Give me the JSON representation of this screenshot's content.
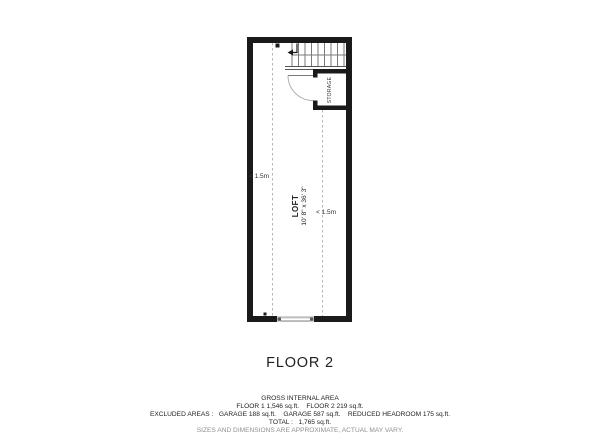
{
  "plan": {
    "loft_label": "LOFT",
    "loft_dimensions": "10' 8\" x 36' 3\"",
    "storage_label": "STORAGE",
    "clearance_left": "< 1.5m",
    "clearance_right": "< 1.5m"
  },
  "floor_title": "FLOOR 2",
  "footer": {
    "gross_internal_area": "GROSS INTERNAL AREA",
    "floor_areas": "FLOOR 1 1,546 sq.ft.    FLOOR 2 219 sq.ft.",
    "excluded_areas": "EXCLUDED AREAS :   GARAGE 188 sq.ft.    GARAGE 587 sq.ft.    REDUCED HEADROOM 175 sq.ft.",
    "total": "TOTAL :   1,765 sq.ft.",
    "disclaimer": "SIZES AND DIMENSIONS ARE APPROXIMATE, ACTUAL MAY VARY."
  },
  "colors": {
    "wall": "#1a1a1a",
    "thin_line": "#8a8a8a",
    "dashed_line": "#b5b5b5",
    "text": "#222222",
    "muted_text": "#909090"
  }
}
